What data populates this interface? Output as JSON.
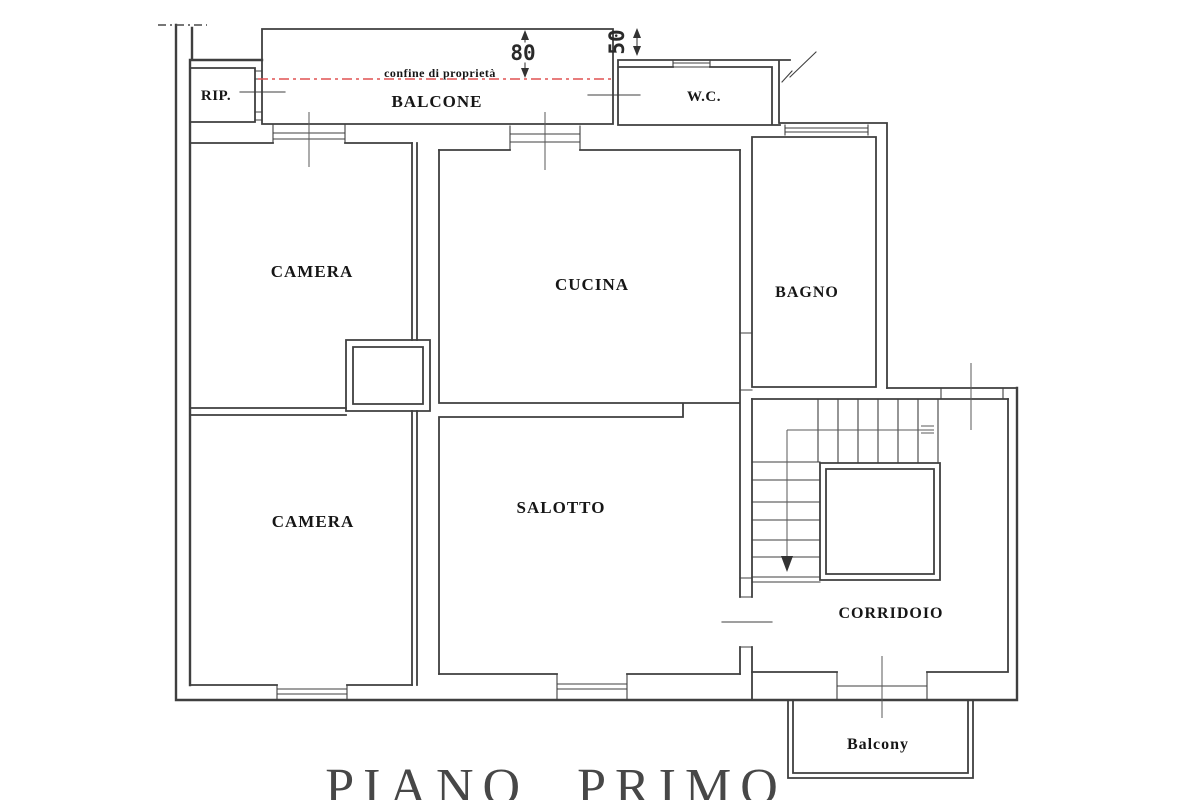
{
  "plan": {
    "title": "PIANO PRIMO",
    "boundary_label": "confine di proprietà",
    "rooms": {
      "rip": "RIP.",
      "balcone": "BALCONE",
      "wc": "W.C.",
      "camera_top": "CAMERA",
      "cucina": "CUCINA",
      "bagno": "BAGNO",
      "camera_bottom": "CAMERA",
      "salotto": "SALOTTO",
      "corridoio": "CORRIDOIO",
      "balcony": "Balcony"
    },
    "dimensions": {
      "balcone_depth": "80",
      "wc_strip": "50"
    },
    "colors": {
      "wall": "#3f3f3f",
      "boundary_line": "#e05252",
      "background": "#ffffff",
      "title": "#474747"
    }
  }
}
